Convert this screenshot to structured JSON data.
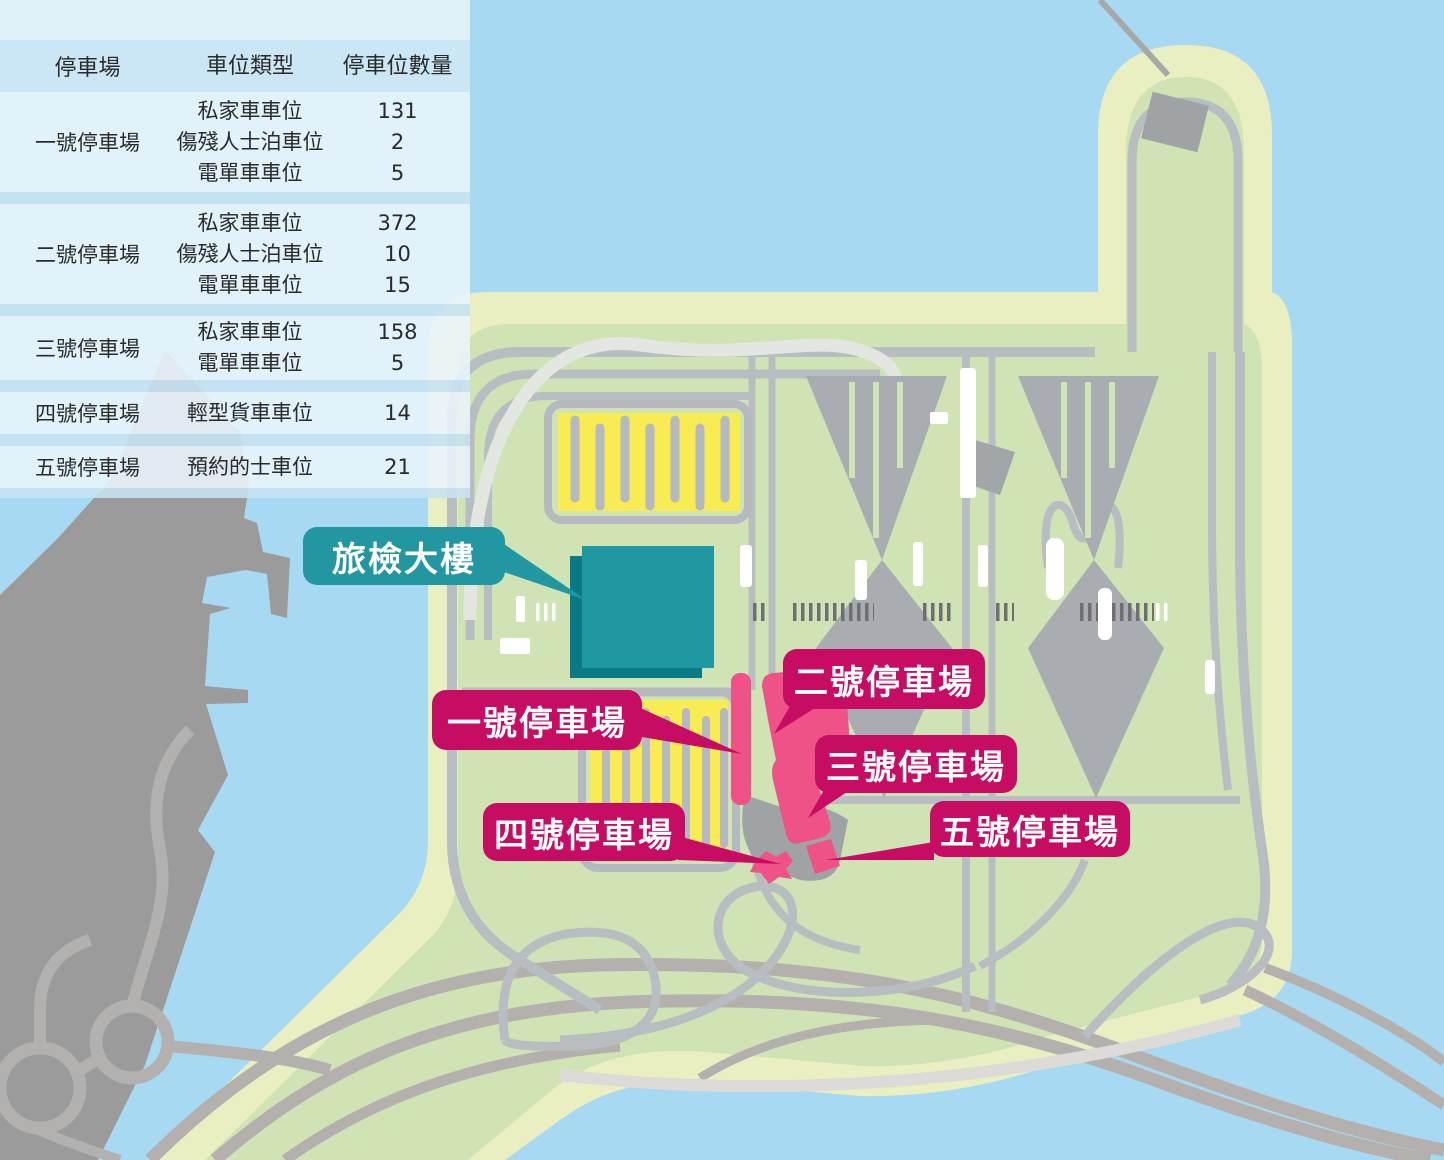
{
  "table": {
    "headers": [
      "停車場",
      "車位類型",
      "停車位數量"
    ],
    "rows": [
      {
        "lot": "一號停車場",
        "entries": [
          {
            "type": "私家車車位",
            "count": "131"
          },
          {
            "type": "傷殘人士泊車位",
            "count": "2"
          },
          {
            "type": "電單車車位",
            "count": "5"
          }
        ]
      },
      {
        "lot": "二號停車場",
        "entries": [
          {
            "type": "私家車車位",
            "count": "372"
          },
          {
            "type": "傷殘人士泊車位",
            "count": "10"
          },
          {
            "type": "電單車車位",
            "count": "15"
          }
        ]
      },
      {
        "lot": "三號停車場",
        "entries": [
          {
            "type": "私家車車位",
            "count": "158"
          },
          {
            "type": "電單車車位",
            "count": "5"
          }
        ]
      },
      {
        "lot": "四號停車場",
        "entries": [
          {
            "type": "輕型貨車車位",
            "count": "14"
          }
        ]
      },
      {
        "lot": "五號停車場",
        "entries": [
          {
            "type": "預約的士車位",
            "count": "21"
          }
        ]
      }
    ]
  },
  "map_labels": {
    "building": "旅檢大樓",
    "lot1": "一號停車場",
    "lot2": "二號停車場",
    "lot3": "三號停車場",
    "lot4": "四號停車場",
    "lot5": "五號停車場"
  },
  "colors": {
    "water": "#a7daf2",
    "island_edge": "#eaefc2",
    "island_land": "#d0e3b4",
    "mainland": "#9b9b9b",
    "road": "#b7bdc1",
    "highway": "#b3b0ae",
    "parking_yellow": "#f8ec52",
    "parking_pink": "#ef5287",
    "label_magenta": "#c60d63",
    "label_teal": "#2397a1",
    "building_teal": "#1f98a2",
    "table_header_bg": "#cde6f5",
    "table_row_bg": "#e9f5fc"
  }
}
